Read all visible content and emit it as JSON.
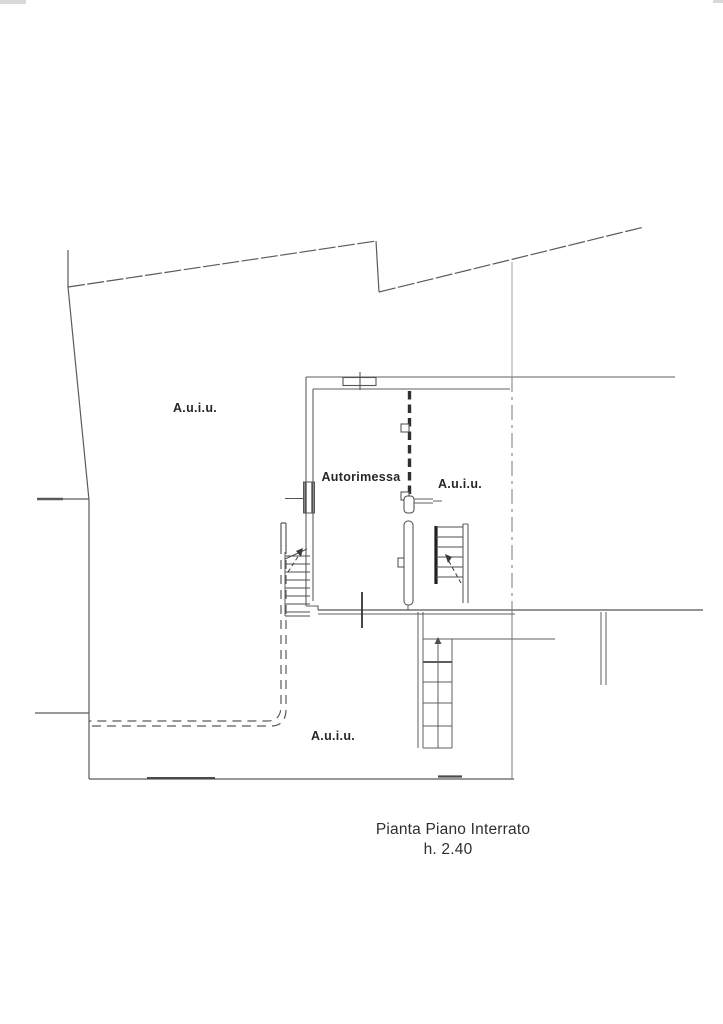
{
  "document": {
    "background": "#ffffff",
    "line_color": "#5f5f5f",
    "dark_line_color": "#2e2e2e",
    "text_color": "#2f2f2f"
  },
  "plan": {
    "labels": {
      "area_upper_left": "A.u.i.u.",
      "garage": "Autorimessa",
      "area_middle": "A.u.i.u.",
      "area_lower": "A.u.i.u."
    },
    "caption": {
      "title": "Pianta Piano Interrato",
      "height_note": "h. 2.40"
    }
  }
}
